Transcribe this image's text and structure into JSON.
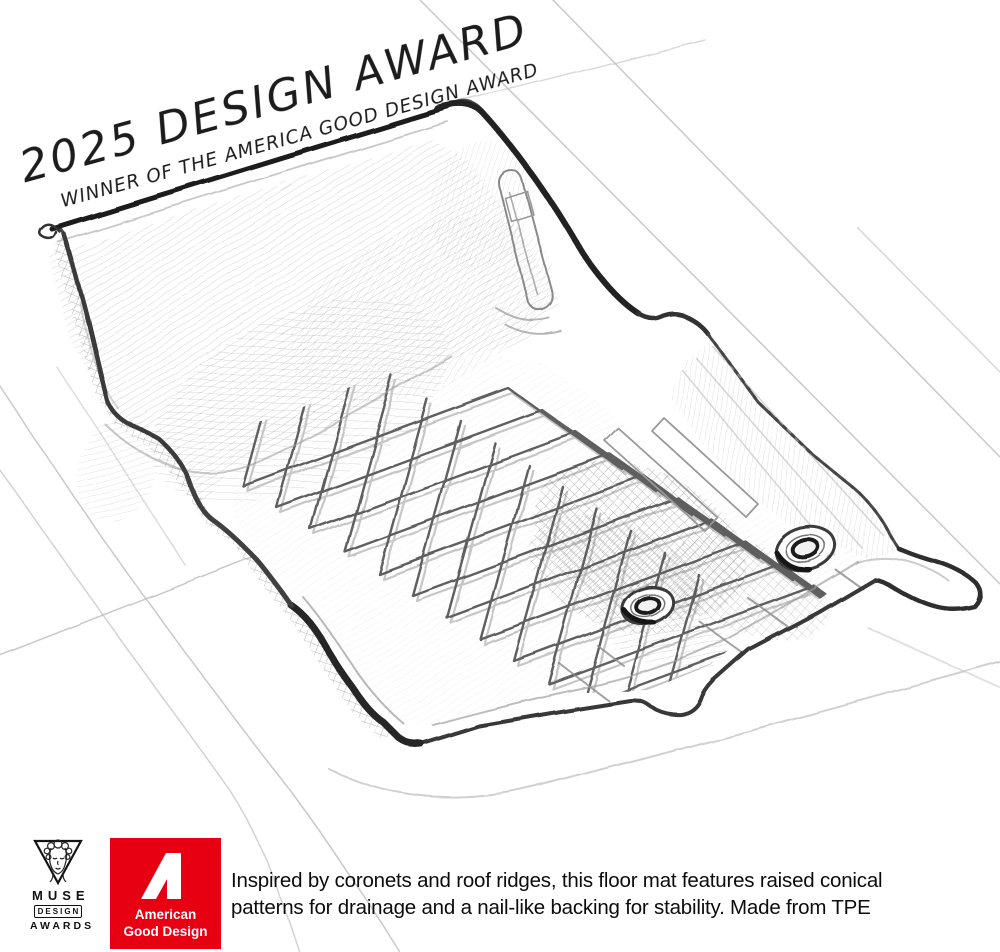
{
  "banner": {
    "title": "2025 DESIGN AWARD",
    "subtitle": "WINNER OF THE AMERICA GOOD DESIGN AWARD"
  },
  "footer": {
    "muse": {
      "word1": "MUSE",
      "word2": "DESIGN",
      "word3": "AWARDS"
    },
    "agd": {
      "line1": "American",
      "line2": "Good Design",
      "brand_color": "#e60012",
      "text_color": "#ffffff"
    },
    "description": {
      "line1": "Inspired by coronets and roof ridges, this floor mat features raised conical",
      "line2": "patterns for drainage and a nail-like backing for stability. Made from TPE"
    }
  },
  "sketch": {
    "subject": "pencil sketch of a vehicle floor mat with chevron drainage ridges and grommets",
    "pencil_color": "#3a3a3a",
    "paper_color": "#ffffff"
  }
}
